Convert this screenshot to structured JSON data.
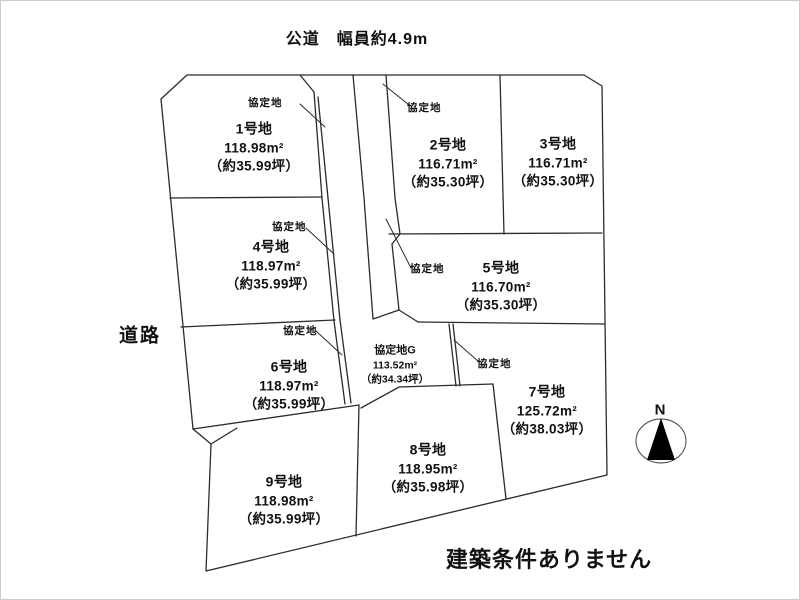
{
  "page": {
    "top_road_label": "公道　幅員約4.9m",
    "left_road_label": "道路",
    "bottom_note": "建築条件ありません",
    "compass_label": "N"
  },
  "plots": [
    {
      "name": "1号地",
      "area": "118.98m²",
      "tsubo": "（約35.99坪）"
    },
    {
      "name": "2号地",
      "area": "116.71m²",
      "tsubo": "（約35.30坪）"
    },
    {
      "name": "3号地",
      "area": "116.71m²",
      "tsubo": "（約35.30坪）"
    },
    {
      "name": "4号地",
      "area": "118.97m²",
      "tsubo": "（約35.99坪）"
    },
    {
      "name": "5号地",
      "area": "116.70m²",
      "tsubo": "（約35.30坪）"
    },
    {
      "name": "6号地",
      "area": "118.97m²",
      "tsubo": "（約35.99坪）"
    },
    {
      "name": "7号地",
      "area": "125.72m²",
      "tsubo": "（約38.03坪）"
    },
    {
      "name": "8号地",
      "area": "118.95m²",
      "tsubo": "（約35.98坪）"
    },
    {
      "name": "9号地",
      "area": "118.98m²",
      "tsubo": "（約35.99坪）"
    }
  ],
  "agreement_area": {
    "name": "協定地G",
    "area": "113.52m²",
    "tsubo": "（約34.34坪）"
  },
  "annotations": [
    {
      "label": "協定地"
    },
    {
      "label": "協定地"
    },
    {
      "label": "協定地"
    },
    {
      "label": "協定地"
    },
    {
      "label": "協定地"
    },
    {
      "label": "協定地"
    }
  ],
  "colors": {
    "line": "#2b2b2b",
    "background": "#ffffff",
    "text": "#111111"
  }
}
